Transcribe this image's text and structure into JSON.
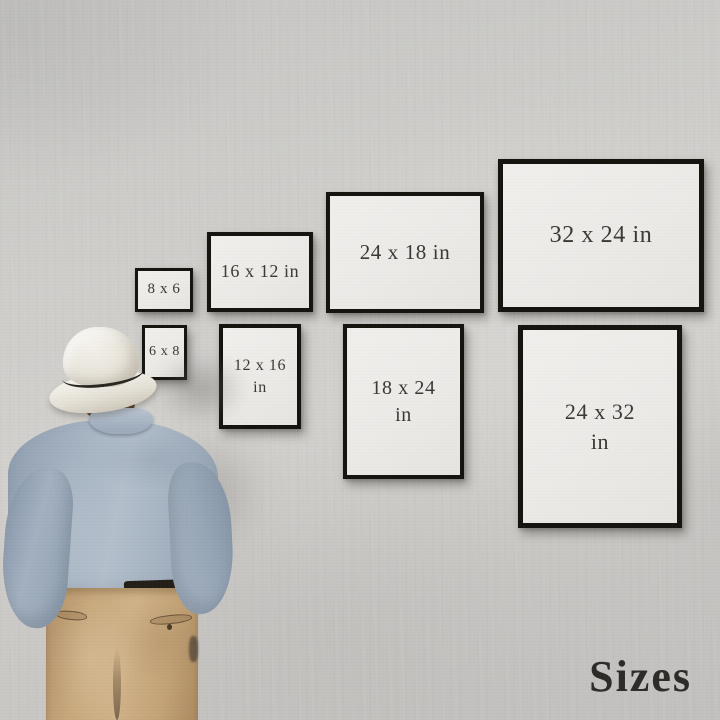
{
  "scene": {
    "description": "Man seen from behind looking at a gallery wall of framed print-size examples",
    "wall_color": "#cecdca",
    "frame_border_color": "#16140f",
    "frame_paper_color": "#edebe8",
    "frame_text_color": "#3a3936"
  },
  "frames": [
    {
      "size": "8 x 6",
      "orientation": "landscape",
      "lines": [
        "8 x 6"
      ]
    },
    {
      "size": "16 x 12 in",
      "orientation": "landscape",
      "lines": [
        "16 x 12 in"
      ]
    },
    {
      "size": "24 x 18 in",
      "orientation": "landscape",
      "lines": [
        "24 x 18 in"
      ]
    },
    {
      "size": "32 x 24 in",
      "orientation": "landscape",
      "lines": [
        "32 x 24 in"
      ]
    },
    {
      "size": "6 x 8",
      "orientation": "portrait",
      "lines": [
        "6 x 8"
      ]
    },
    {
      "size": "12 x 16 in",
      "orientation": "portrait",
      "lines": [
        "12 x 16",
        "in"
      ]
    },
    {
      "size": "18 x 24 in",
      "orientation": "portrait",
      "lines": [
        "18 x 24",
        "in"
      ]
    },
    {
      "size": "24 x 32 in",
      "orientation": "portrait",
      "lines": [
        "24 x 32",
        "in"
      ]
    }
  ],
  "caption": {
    "text": "Sizes",
    "color": "#2d2c29"
  },
  "figure": {
    "description": "Man from behind wearing cream fedora with dark band, light blue shirt, khaki trousers with dark belt",
    "hat_color": "#ece8e0",
    "hat_band_color": "#2b2620",
    "hair_color": "#4e3322",
    "shirt_color": "#a5b2c1",
    "trousers_color": "#c7a87c",
    "belt_color": "#242019"
  }
}
